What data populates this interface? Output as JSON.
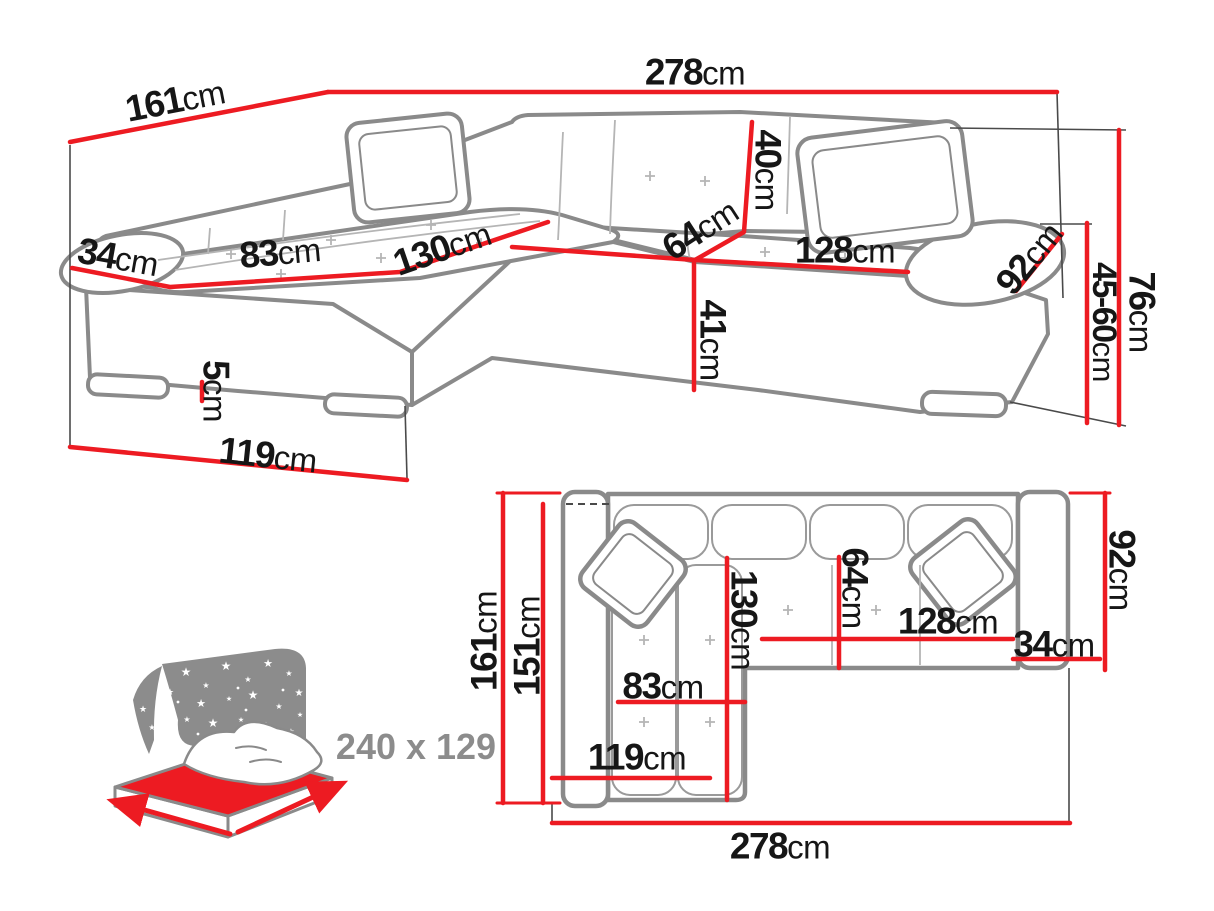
{
  "colors": {
    "dimension_red": "#ed1b22",
    "drawing_gray": "#8a8a8a",
    "seam_gray": "#b5b5b5",
    "text_black": "#161616",
    "icon_gray": "#8c8c8c"
  },
  "perspective": {
    "total_width": {
      "value": "278",
      "unit": "cm"
    },
    "total_depth": {
      "value": "161",
      "unit": "cm"
    },
    "armrest_width": {
      "value": "34",
      "unit": "cm"
    },
    "chaise_seat_width": {
      "value": "83",
      "unit": "cm"
    },
    "chaise_length": {
      "value": "130",
      "unit": "cm"
    },
    "backrest_thickness": {
      "value": "40",
      "unit": "cm"
    },
    "seat_depth": {
      "value": "64",
      "unit": "cm"
    },
    "seat_width": {
      "value": "128",
      "unit": "cm"
    },
    "armrest_depth": {
      "value": "92",
      "unit": "cm"
    },
    "seat_height": {
      "value": "41",
      "unit": "cm"
    },
    "leg_height": {
      "value": "5",
      "unit": "cm"
    },
    "chaise_front_width": {
      "value": "119",
      "unit": "cm"
    },
    "total_height": {
      "value": "76",
      "unit": "cm"
    },
    "backrest_height_range": {
      "value": "45-60",
      "unit": "cm"
    }
  },
  "plan": {
    "total_depth": {
      "value": "161",
      "unit": "cm"
    },
    "inner_depth": {
      "value": "151",
      "unit": "cm"
    },
    "chaise_length": {
      "value": "130",
      "unit": "cm"
    },
    "seat_depth": {
      "value": "64",
      "unit": "cm"
    },
    "seat_width": {
      "value": "128",
      "unit": "cm"
    },
    "armrest_width": {
      "value": "34",
      "unit": "cm"
    },
    "armrest_depth": {
      "value": "92",
      "unit": "cm"
    },
    "chaise_seat_width": {
      "value": "83",
      "unit": "cm"
    },
    "chaise_front_width": {
      "value": "119",
      "unit": "cm"
    },
    "total_width": {
      "value": "278",
      "unit": "cm"
    }
  },
  "sleeping_area": {
    "label": "240 x 129"
  }
}
